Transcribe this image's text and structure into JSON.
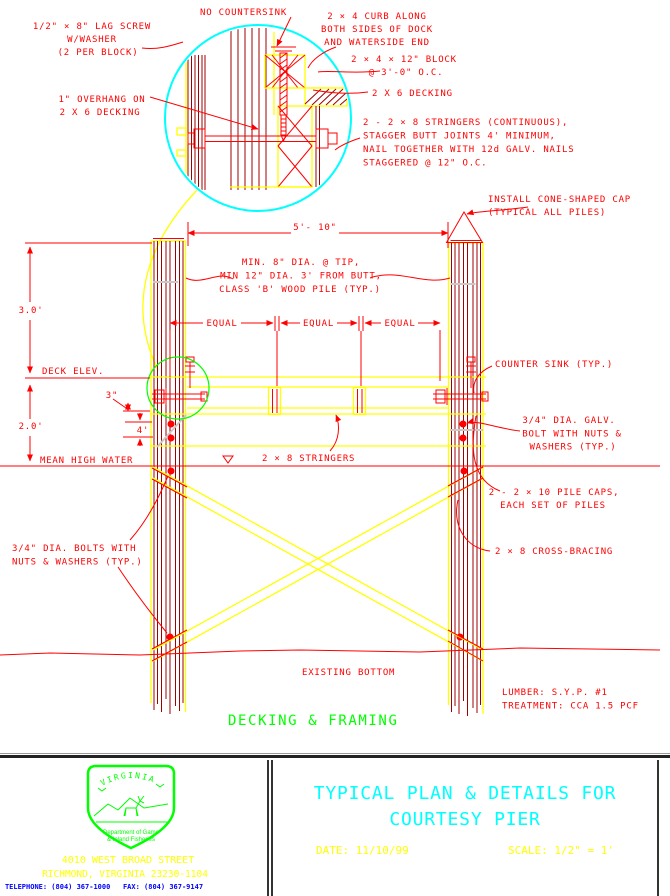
{
  "drawing": {
    "caption": "DECKING & FRAMING",
    "labels": {
      "no_countersink": "NO COUNTERSINK",
      "lag_screw_1": "1/2\" × 8\" LAG SCREW",
      "lag_screw_2": "W/WASHER",
      "lag_screw_3": "(2 PER BLOCK)",
      "overhang_1": "1\" OVERHANG ON",
      "overhang_2": "2 X 6 DECKING",
      "curb_1": "2 × 4 CURB ALONG",
      "curb_2": "BOTH SIDES OF DOCK",
      "curb_3": "AND WATERSIDE END",
      "block_1": "2 × 4 × 12\" BLOCK",
      "block_2": "@ 3'-0\" O.C.",
      "decking": "2 X 6 DECKING",
      "stringers_note_1": "2 - 2 × 8 STRINGERS (CONTINUOUS),",
      "stringers_note_2": "STAGGER BUTT JOINTS 4' MINIMUM,",
      "stringers_note_3": "NAIL TOGETHER WITH 12d GALV. NAILS",
      "stringers_note_4": "STAGGERED @ 12\" O.C.",
      "cone_cap_1": "INSTALL CONE-SHAPED CAP",
      "cone_cap_2": "(TYPICAL ALL PILES)",
      "pile_note_1": "MIN. 8\" DIA. @ TIP,",
      "pile_note_2": "MIN 12\" DIA. 3' FROM BUTT,",
      "pile_note_3": "CLASS 'B' WOOD PILE (TYP.)",
      "counter_sink": "COUNTER SINK (TYP.)",
      "galv_bolt_1": "3/4\" DIA. GALV.",
      "galv_bolt_2": "BOLT WITH NUTS &",
      "galv_bolt_3": "WASHERS (TYP.)",
      "deck_elev": "DECK ELEV.",
      "mean_high_water": "MEAN HIGH WATER",
      "stringers": "2 × 8 STRINGERS",
      "pile_caps_1": "2 - 2 × 10 PILE CAPS,",
      "pile_caps_2": "EACH SET OF PILES",
      "cross_bracing": "2 × 8 CROSS-BRACING",
      "bolts_1": "3/4\" DIA. BOLTS WITH",
      "bolts_2": "NUTS & WASHERS (TYP.)",
      "existing_bottom": "EXISTING BOTTOM",
      "lumber": "LUMBER: S.Y.P. #1",
      "treatment": "TREATMENT: CCA 1.5 PCF"
    },
    "dimensions": {
      "span": "5'- 10\"",
      "equal": "EQUAL",
      "above_deck": "3.0'",
      "deck_to_water": "2.0'",
      "curb_offset": "3\"",
      "bolt_spacing": "4'"
    },
    "colors": {
      "line_red": "#FF0000",
      "line_yellow": "#FFFF00",
      "detail_circle_cyan": "#00FFFF",
      "detail_circle_green": "#00FF00",
      "wood_maroon": "#A00000",
      "splice_gray": "#C8C8C8"
    }
  },
  "title_block": {
    "title_1": "TYPICAL PLAN & DETAILS FOR",
    "title_2": "COURTESY PIER",
    "date": "DATE: 11/10/99",
    "scale": "SCALE: 1/2\" = 1'",
    "address_1": "4010 WEST BROAD STREET",
    "address_2": "RICHMOND, VIRGINIA 23230-1104",
    "phone": "TELEPHONE: (804) 367-1000   FAX: (804) 367-9147",
    "logo": {
      "state": "VIRGINIA",
      "dept_1": "Department of Game",
      "dept_2": "& Inland Fisheries"
    }
  }
}
